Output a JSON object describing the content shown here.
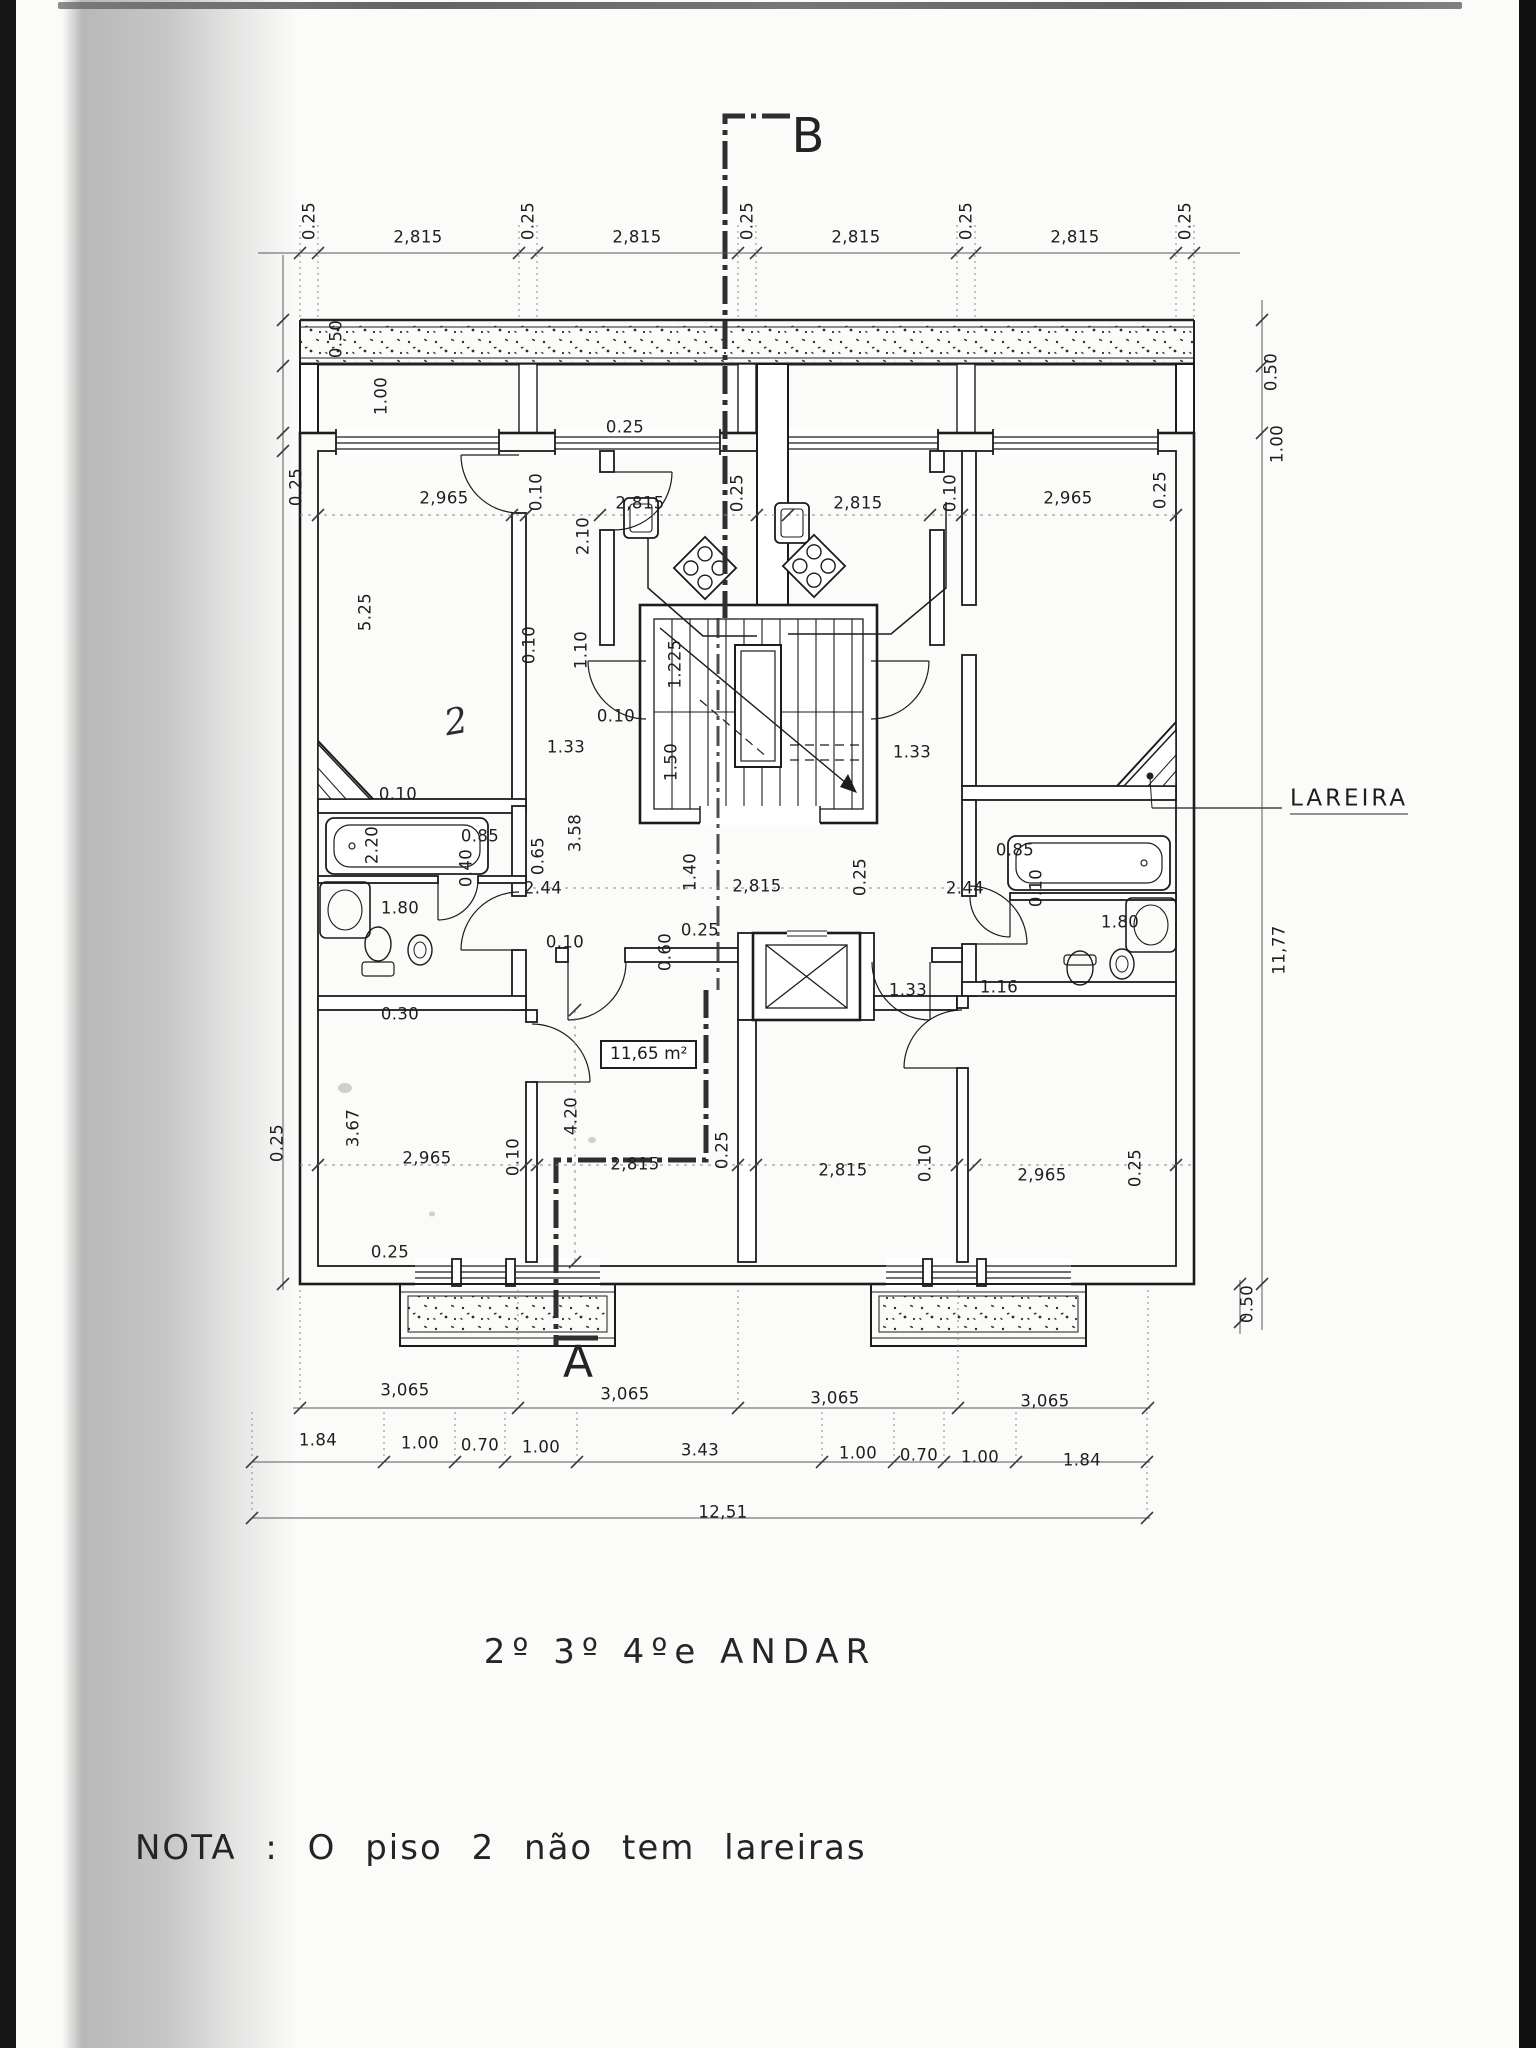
{
  "page": {
    "title": "2º 3º 4ºe ANDAR",
    "note": "NOTA : O  piso 2  não  tem  lareiras"
  },
  "plan": {
    "floor_area_label": "11,65 m²",
    "fireplace_label": "LAREIRA",
    "handwritten_mark": "2",
    "section_markers": {
      "top": "B",
      "bottom": "A"
    }
  },
  "dimension_labels": [
    {
      "t": "0.25",
      "x": 309,
      "y": 221,
      "r": 1
    },
    {
      "t": "2,815",
      "x": 418,
      "y": 237
    },
    {
      "t": "0.25",
      "x": 528,
      "y": 221,
      "r": 1
    },
    {
      "t": "2,815",
      "x": 637,
      "y": 237
    },
    {
      "t": "0.25",
      "x": 747,
      "y": 221,
      "r": 1
    },
    {
      "t": "2,815",
      "x": 856,
      "y": 237
    },
    {
      "t": "0.25",
      "x": 966,
      "y": 221,
      "r": 1
    },
    {
      "t": "2,815",
      "x": 1075,
      "y": 237
    },
    {
      "t": "0.25",
      "x": 1185,
      "y": 221,
      "r": 1
    },
    {
      "t": "0.50",
      "x": 336,
      "y": 339,
      "r": 1
    },
    {
      "t": "1.00",
      "x": 381,
      "y": 396,
      "r": 1
    },
    {
      "t": "0.50",
      "x": 1271,
      "y": 372,
      "r": 1
    },
    {
      "t": "1.00",
      "x": 1277,
      "y": 444,
      "r": 1
    },
    {
      "t": "0.25",
      "x": 296,
      "y": 487,
      "r": 1
    },
    {
      "t": "2,965",
      "x": 444,
      "y": 498
    },
    {
      "t": "0.10",
      "x": 536,
      "y": 492,
      "r": 1
    },
    {
      "t": "2,815",
      "x": 640,
      "y": 503
    },
    {
      "t": "0.25",
      "x": 737,
      "y": 493,
      "r": 1
    },
    {
      "t": "2,815",
      "x": 858,
      "y": 503
    },
    {
      "t": "0.10",
      "x": 950,
      "y": 493,
      "r": 1
    },
    {
      "t": "2,965",
      "x": 1068,
      "y": 498
    },
    {
      "t": "0.25",
      "x": 1160,
      "y": 490,
      "r": 1
    },
    {
      "t": "0.25",
      "x": 625,
      "y": 427
    },
    {
      "t": "2.10",
      "x": 583,
      "y": 536,
      "r": 1
    },
    {
      "t": "1.10",
      "x": 581,
      "y": 650,
      "r": 1
    },
    {
      "t": "0.10",
      "x": 529,
      "y": 645,
      "r": 1
    },
    {
      "t": "1.225",
      "x": 675,
      "y": 664,
      "r": 1
    },
    {
      "t": "1.50",
      "x": 671,
      "y": 762,
      "r": 1
    },
    {
      "t": "1.33",
      "x": 566,
      "y": 747
    },
    {
      "t": "1.33",
      "x": 912,
      "y": 752
    },
    {
      "t": "0.10",
      "x": 616,
      "y": 716
    },
    {
      "t": "5.25",
      "x": 365,
      "y": 612,
      "r": 1
    },
    {
      "t": "0.10",
      "x": 398,
      "y": 794
    },
    {
      "t": "2.20",
      "x": 372,
      "y": 845,
      "r": 1
    },
    {
      "t": "1.80",
      "x": 400,
      "y": 908
    },
    {
      "t": "0.85",
      "x": 480,
      "y": 836
    },
    {
      "t": "0.65",
      "x": 538,
      "y": 856,
      "r": 1
    },
    {
      "t": "0.40",
      "x": 466,
      "y": 868,
      "r": 1
    },
    {
      "t": "2.44",
      "x": 543,
      "y": 888
    },
    {
      "t": "0.30",
      "x": 400,
      "y": 1014
    },
    {
      "t": "0.85",
      "x": 1015,
      "y": 850
    },
    {
      "t": "0.10",
      "x": 1036,
      "y": 888,
      "r": 1
    },
    {
      "t": "2.44",
      "x": 965,
      "y": 888
    },
    {
      "t": "1.80",
      "x": 1120,
      "y": 922
    },
    {
      "t": "1.16",
      "x": 999,
      "y": 987
    },
    {
      "t": "1.33",
      "x": 908,
      "y": 990
    },
    {
      "t": "3.58",
      "x": 575,
      "y": 833,
      "r": 1
    },
    {
      "t": "1.40",
      "x": 690,
      "y": 872,
      "r": 1
    },
    {
      "t": "2,815",
      "x": 757,
      "y": 886
    },
    {
      "t": "0.25",
      "x": 860,
      "y": 877,
      "r": 1
    },
    {
      "t": "0.10",
      "x": 565,
      "y": 942
    },
    {
      "t": "0.60",
      "x": 665,
      "y": 952,
      "r": 1
    },
    {
      "t": "0.25",
      "x": 700,
      "y": 930
    },
    {
      "t": "4.20",
      "x": 571,
      "y": 1116,
      "r": 1
    },
    {
      "t": "2,815",
      "x": 635,
      "y": 1164
    },
    {
      "t": "0.25",
      "x": 722,
      "y": 1150,
      "r": 1
    },
    {
      "t": "2,815",
      "x": 843,
      "y": 1170
    },
    {
      "t": "0.10",
      "x": 925,
      "y": 1163,
      "r": 1
    },
    {
      "t": "2,965",
      "x": 1042,
      "y": 1175
    },
    {
      "t": "0.25",
      "x": 1135,
      "y": 1168,
      "r": 1
    },
    {
      "t": "3.67",
      "x": 353,
      "y": 1128,
      "r": 1
    },
    {
      "t": "0.25",
      "x": 277,
      "y": 1143,
      "r": 1
    },
    {
      "t": "2,965",
      "x": 427,
      "y": 1158
    },
    {
      "t": "0.10",
      "x": 513,
      "y": 1157,
      "r": 1
    },
    {
      "t": "0.25",
      "x": 390,
      "y": 1252
    },
    {
      "t": "3,065",
      "x": 405,
      "y": 1390
    },
    {
      "t": "3,065",
      "x": 625,
      "y": 1394
    },
    {
      "t": "3,065",
      "x": 835,
      "y": 1398
    },
    {
      "t": "3,065",
      "x": 1045,
      "y": 1401
    },
    {
      "t": "1.84",
      "x": 318,
      "y": 1440
    },
    {
      "t": "1.00",
      "x": 420,
      "y": 1443
    },
    {
      "t": "0.70",
      "x": 480,
      "y": 1445
    },
    {
      "t": "1.00",
      "x": 541,
      "y": 1447
    },
    {
      "t": "3.43",
      "x": 700,
      "y": 1450
    },
    {
      "t": "1.00",
      "x": 858,
      "y": 1453
    },
    {
      "t": "0.70",
      "x": 919,
      "y": 1455
    },
    {
      "t": "1.00",
      "x": 980,
      "y": 1457
    },
    {
      "t": "1.84",
      "x": 1082,
      "y": 1460
    },
    {
      "t": "12,51",
      "x": 723,
      "y": 1512
    },
    {
      "t": "11,77",
      "x": 1279,
      "y": 950,
      "r": 1
    },
    {
      "t": "0.50",
      "x": 1247,
      "y": 1304,
      "r": 1
    }
  ]
}
